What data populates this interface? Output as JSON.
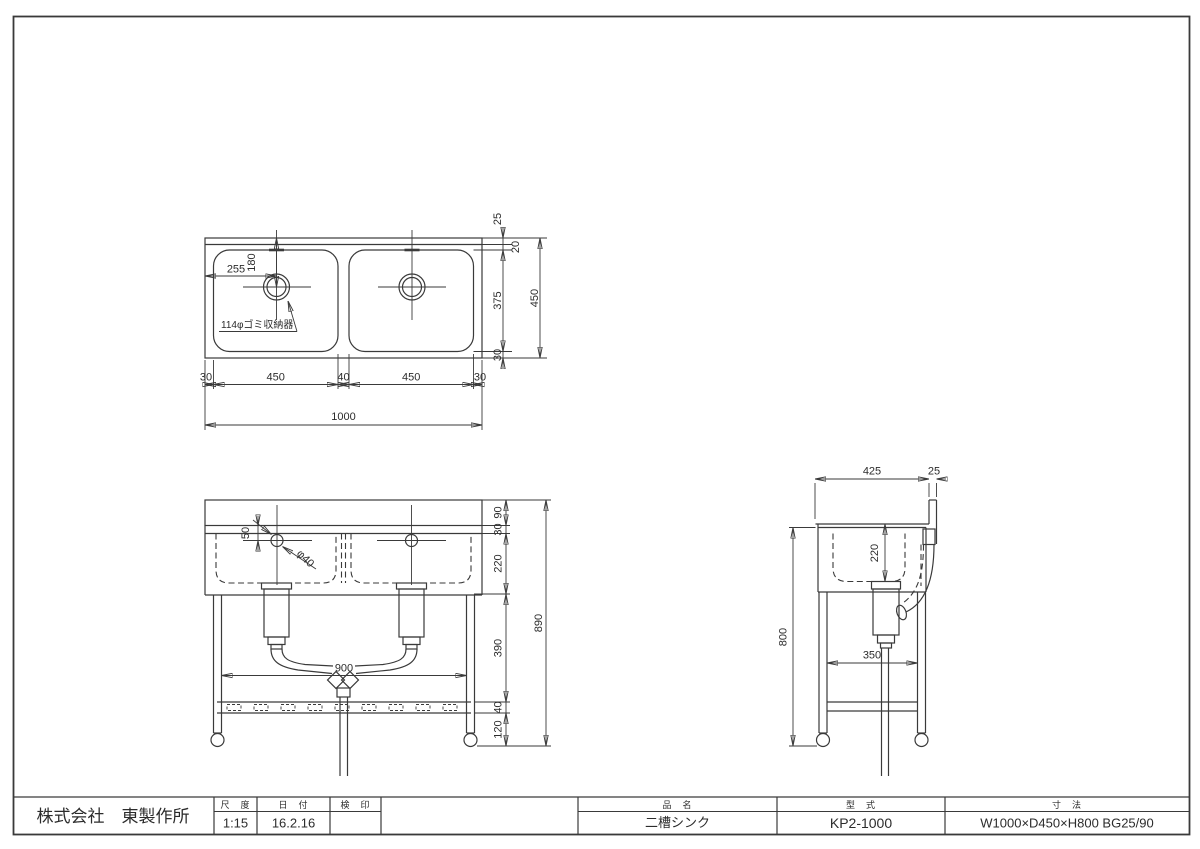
{
  "plan": {
    "note": "114φゴミ収納器",
    "drainx": "255",
    "drainy": "180",
    "w30l": "30",
    "w450l": "450",
    "w40": "40",
    "w450r": "450",
    "w30r": "30",
    "w1000": "1000",
    "h25": "25",
    "h20": "20",
    "h375": "375",
    "h30": "30",
    "h450": "450"
  },
  "front": {
    "v50": "50",
    "phi40": "φ40",
    "span900": "900",
    "h90": "90",
    "h30": "30",
    "h220": "220",
    "h390": "390",
    "h40": "40",
    "h120": "120",
    "h890": "890"
  },
  "side": {
    "d425": "425",
    "d25": "25",
    "d220": "220",
    "d800": "800",
    "d350": "350"
  },
  "titleblock": {
    "company": "株式会社　東製作所",
    "scale_label": "尺　度",
    "scale": "1:15",
    "date_label": "日　付",
    "date": "16.2.16",
    "stamp_label": "検　印",
    "stamp": "",
    "name_label": "品　名",
    "name": "二槽シンク",
    "model_label": "型　式",
    "model": "KP2-1000",
    "size_label": "寸　法",
    "size": "W1000×D450×H800 BG25/90"
  }
}
